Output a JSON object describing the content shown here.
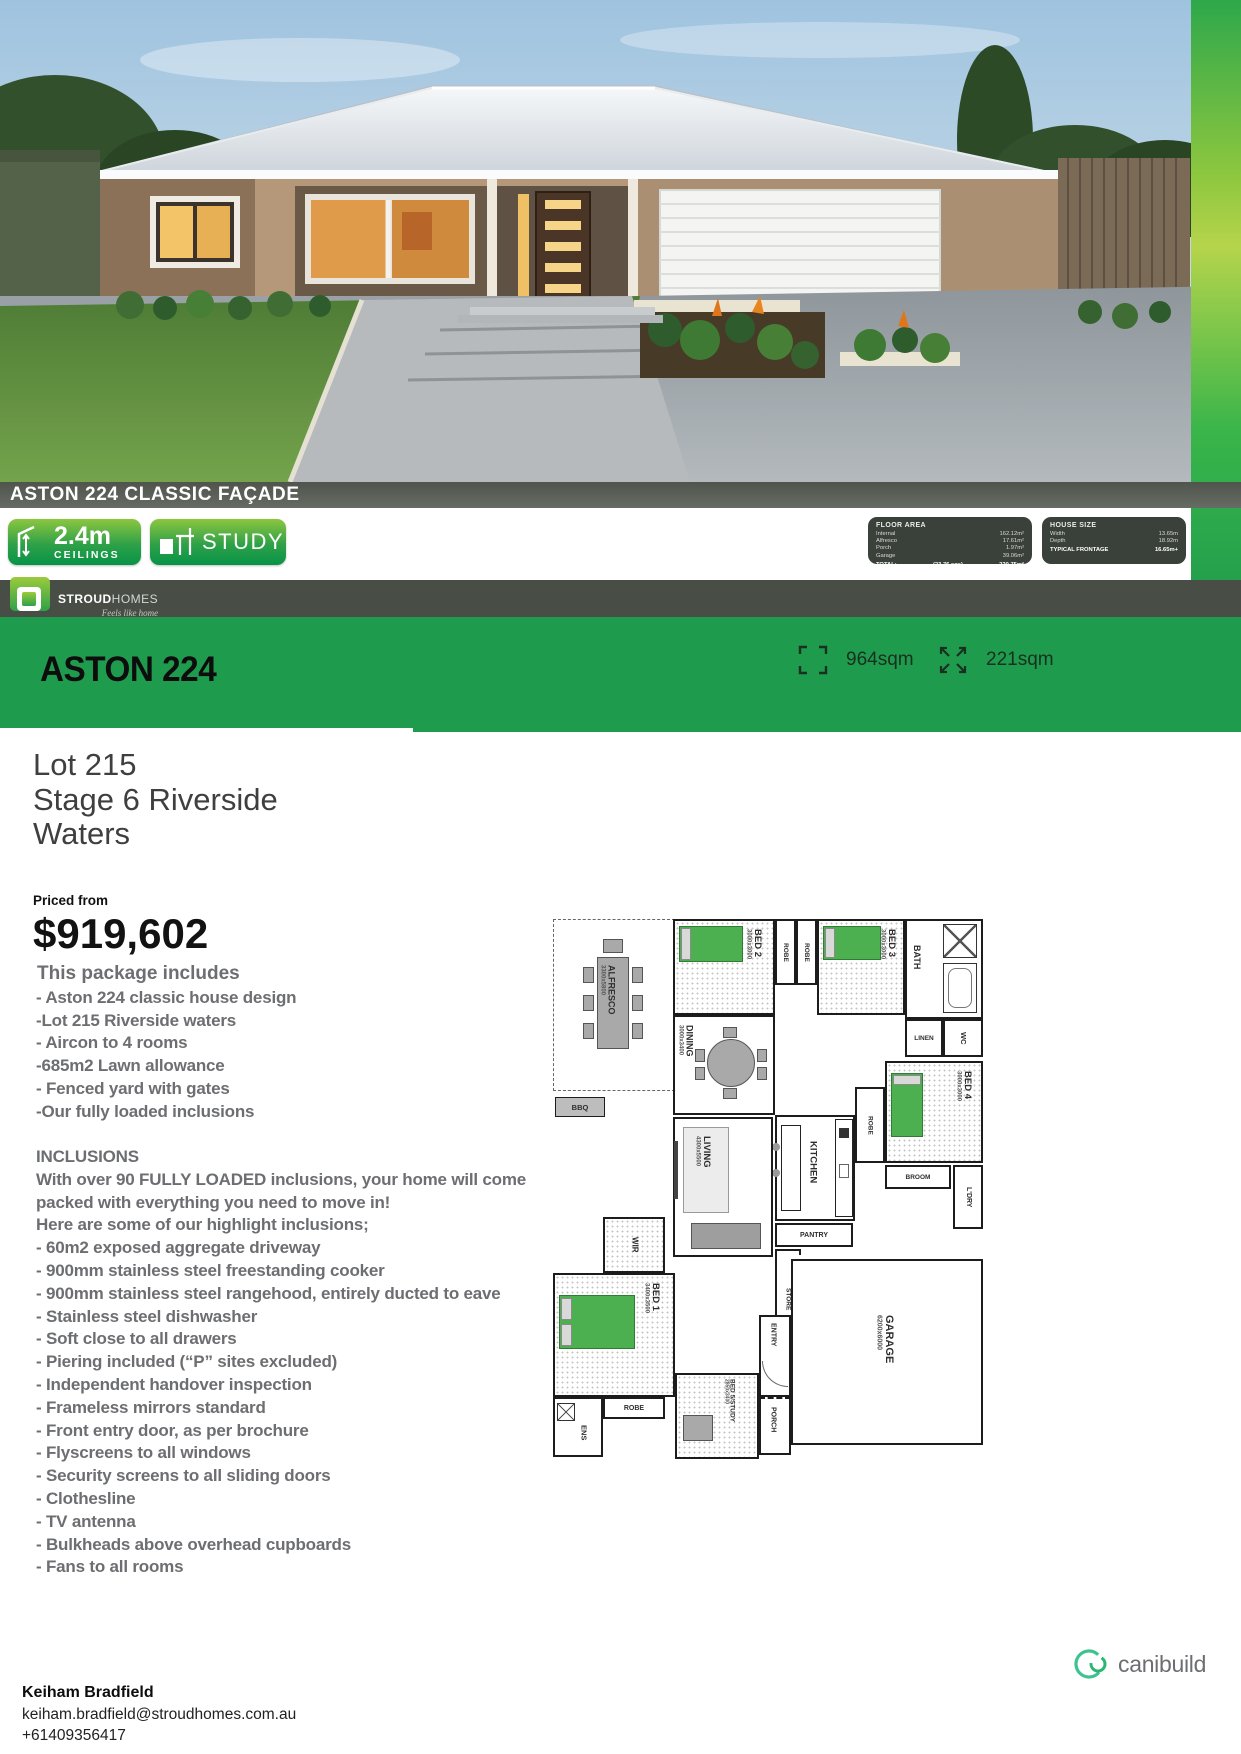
{
  "facade_banner": "ASTON 224 CLASSIC FAÇADE",
  "badges": {
    "ceiling_value": "2.4m",
    "ceiling_label": "CEILINGS",
    "study_label": "STUDY"
  },
  "floor_area": {
    "title": "FLOOR AREA",
    "rows": [
      {
        "label": "Internal",
        "value": "162.12m²"
      },
      {
        "label": "Alfresco",
        "value": "17.61m²"
      },
      {
        "label": "Porch",
        "value": "1.97m²"
      },
      {
        "label": "Garage",
        "value": "39.06m²"
      }
    ],
    "total_label": "TOTAL:",
    "total_sqs": "(23.76 sqs)",
    "total_value": "220.75m²"
  },
  "house_size": {
    "title": "HOUSE SIZE",
    "rows": [
      {
        "label": "Width",
        "value": "13.65m"
      },
      {
        "label": "Depth",
        "value": "18.92m"
      }
    ],
    "frontage_label": "TYPICAL FRONTAGE",
    "frontage_value": "16.65m+"
  },
  "stroud": {
    "name_bold": "STROUD",
    "name_light": "HOMES",
    "tagline": "Feels like home"
  },
  "title_band": {
    "title": "ASTON 224",
    "land_area": "964sqm",
    "house_area": "221sqm"
  },
  "listing": {
    "lot_lines": [
      "Lot 215",
      "Stage 6 Riverside",
      "Waters"
    ],
    "priced_from": "Priced from",
    "price": "$919,602",
    "package_heading": "This package includes",
    "package_items": [
      "- Aston 224 classic house design",
      "-Lot 215 Riverside waters",
      "- Aircon to 4 rooms",
      "-685m2 Lawn allowance",
      "- Fenced yard with gates",
      "-Our fully loaded inclusions"
    ],
    "inclusions_heading": "INCLUSIONS",
    "inclusions_intro": [
      "With over 90 FULLY LOADED inclusions, your home will come",
      "packed with everything you need to move in!",
      "Here are some of our highlight inclusions;"
    ],
    "inclusions_items": [
      "- 60m2 exposed aggregate driveway",
      "- 900mm stainless steel freestanding cooker",
      "- 900mm stainless steel rangehood, entirely ducted to eave",
      "- Stainless steel dishwasher",
      "- Soft close to all drawers",
      "- Piering included (“P” sites excluded)",
      "- Independent handover inspection",
      "- Frameless mirrors standard",
      "- Front entry door, as per brochure",
      "- Flyscreens to all windows",
      "- Security screens to all sliding doors",
      "- Clothesline",
      "- TV antenna",
      "- Bulkheads above overhead cupboards",
      "- Fans to all rooms"
    ]
  },
  "floorplan": {
    "alfresco": {
      "name": "ALFRESCO",
      "dims": "3300x5800"
    },
    "bbq": "BBQ",
    "bed2": {
      "name": "BED 2",
      "dims": "3000x3000"
    },
    "bed3": {
      "name": "BED 3",
      "dims": "3000x3000"
    },
    "bed4": {
      "name": "BED 4",
      "dims": "3000x3000"
    },
    "bed1": {
      "name": "BED 1",
      "dims": "3400x3500"
    },
    "bed5": {
      "name": "BED 5/STUDY",
      "dims": "2850x3400"
    },
    "dining": {
      "name": "DINING",
      "dims": "3000x3400"
    },
    "living": {
      "name": "LIVING",
      "dims": "4300x5500"
    },
    "garage": {
      "name": "GARAGE",
      "dims": "6200x6000"
    },
    "kitchen": "KITCHEN",
    "bath": "BATH",
    "wc": "WC",
    "linen": "LINEN",
    "robe": "ROBE",
    "ldry": "L'DRY",
    "pantry": "PANTRY",
    "broom": "BROOM",
    "store": "STORE",
    "wir": "WIR",
    "entry": "ENTRY",
    "ens": "ENS",
    "porch": "PORCH"
  },
  "footer": {
    "brand": "canibuild",
    "agent_name": "Keiham Bradfield",
    "agent_email": "keiham.bradfield@stroudhomes.com.au",
    "agent_phone": "+61409356417"
  }
}
